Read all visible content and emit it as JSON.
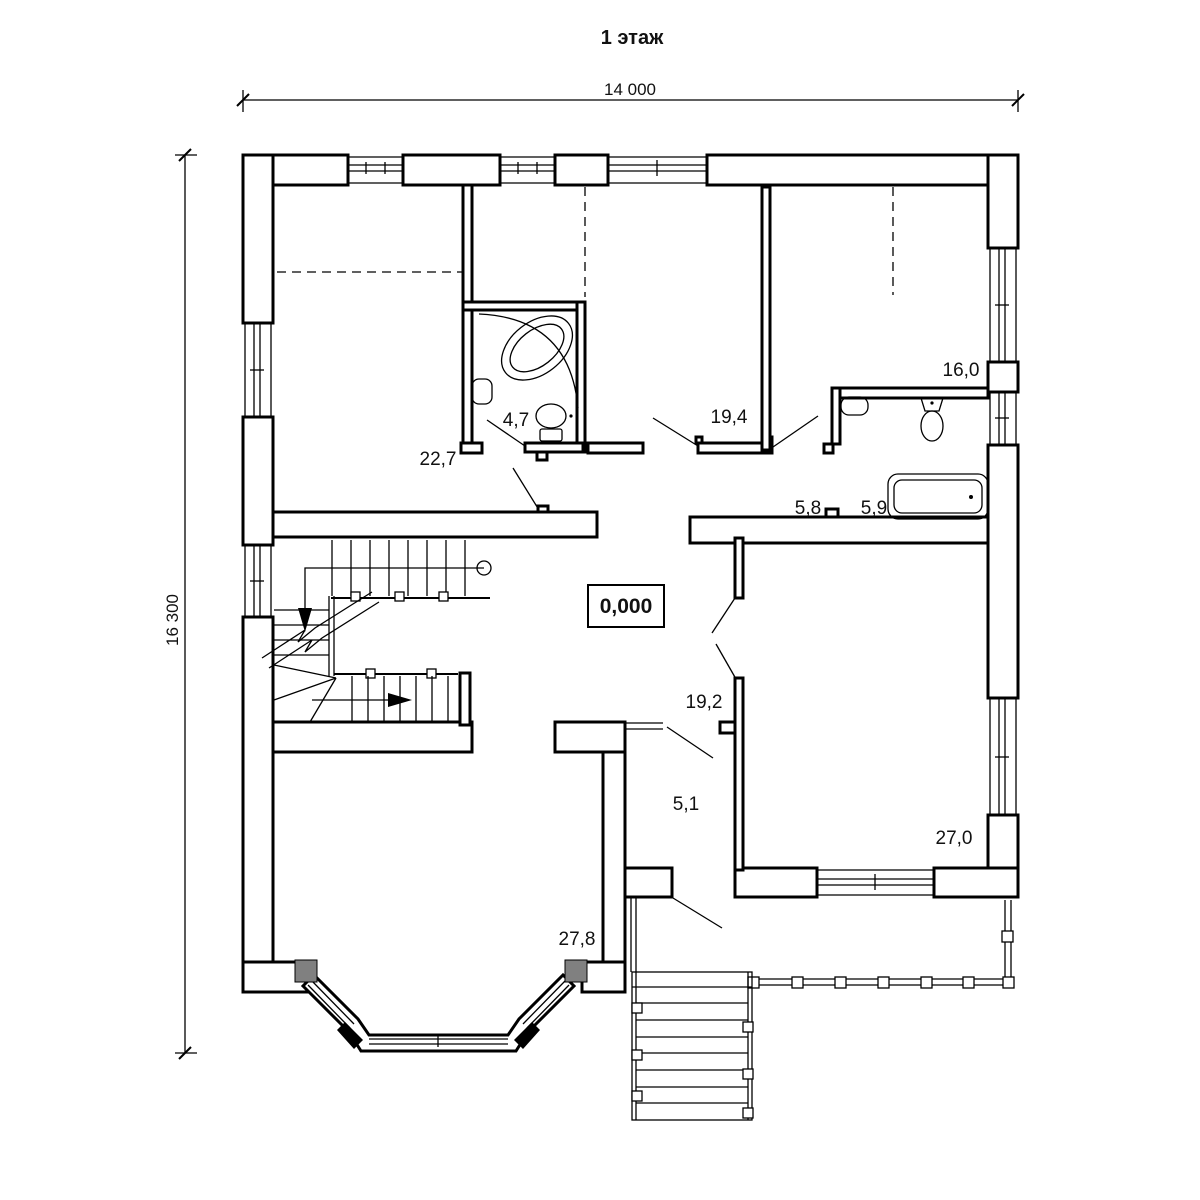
{
  "title": "1 этаж",
  "dimensions": {
    "width_mm": "14 000",
    "height_mm": "16 300"
  },
  "elevation_mark": "0,000",
  "rooms": [
    {
      "id": "room-22-7",
      "area": "22,7"
    },
    {
      "id": "bathroom-4-7",
      "area": "4,7"
    },
    {
      "id": "room-19-4",
      "area": "19,4"
    },
    {
      "id": "room-16-0",
      "area": "16,0"
    },
    {
      "id": "corridor-5-8",
      "area": "5,8"
    },
    {
      "id": "bathroom-5-9",
      "area": "5,9"
    },
    {
      "id": "hall-19-2",
      "area": "19,2"
    },
    {
      "id": "corridor-5-1",
      "area": "5,1"
    },
    {
      "id": "room-27-0",
      "area": "27,0"
    },
    {
      "id": "room-27-8",
      "area": "27,8"
    }
  ],
  "colors": {
    "line": "#000000",
    "pillar": "#808080",
    "background": "#ffffff"
  },
  "icons": [
    "corner-bathtub-icon",
    "bathtub-icon",
    "toilet-icon",
    "sink-icon",
    "stair-down-arrow-icon",
    "stair-right-arrow-icon"
  ]
}
